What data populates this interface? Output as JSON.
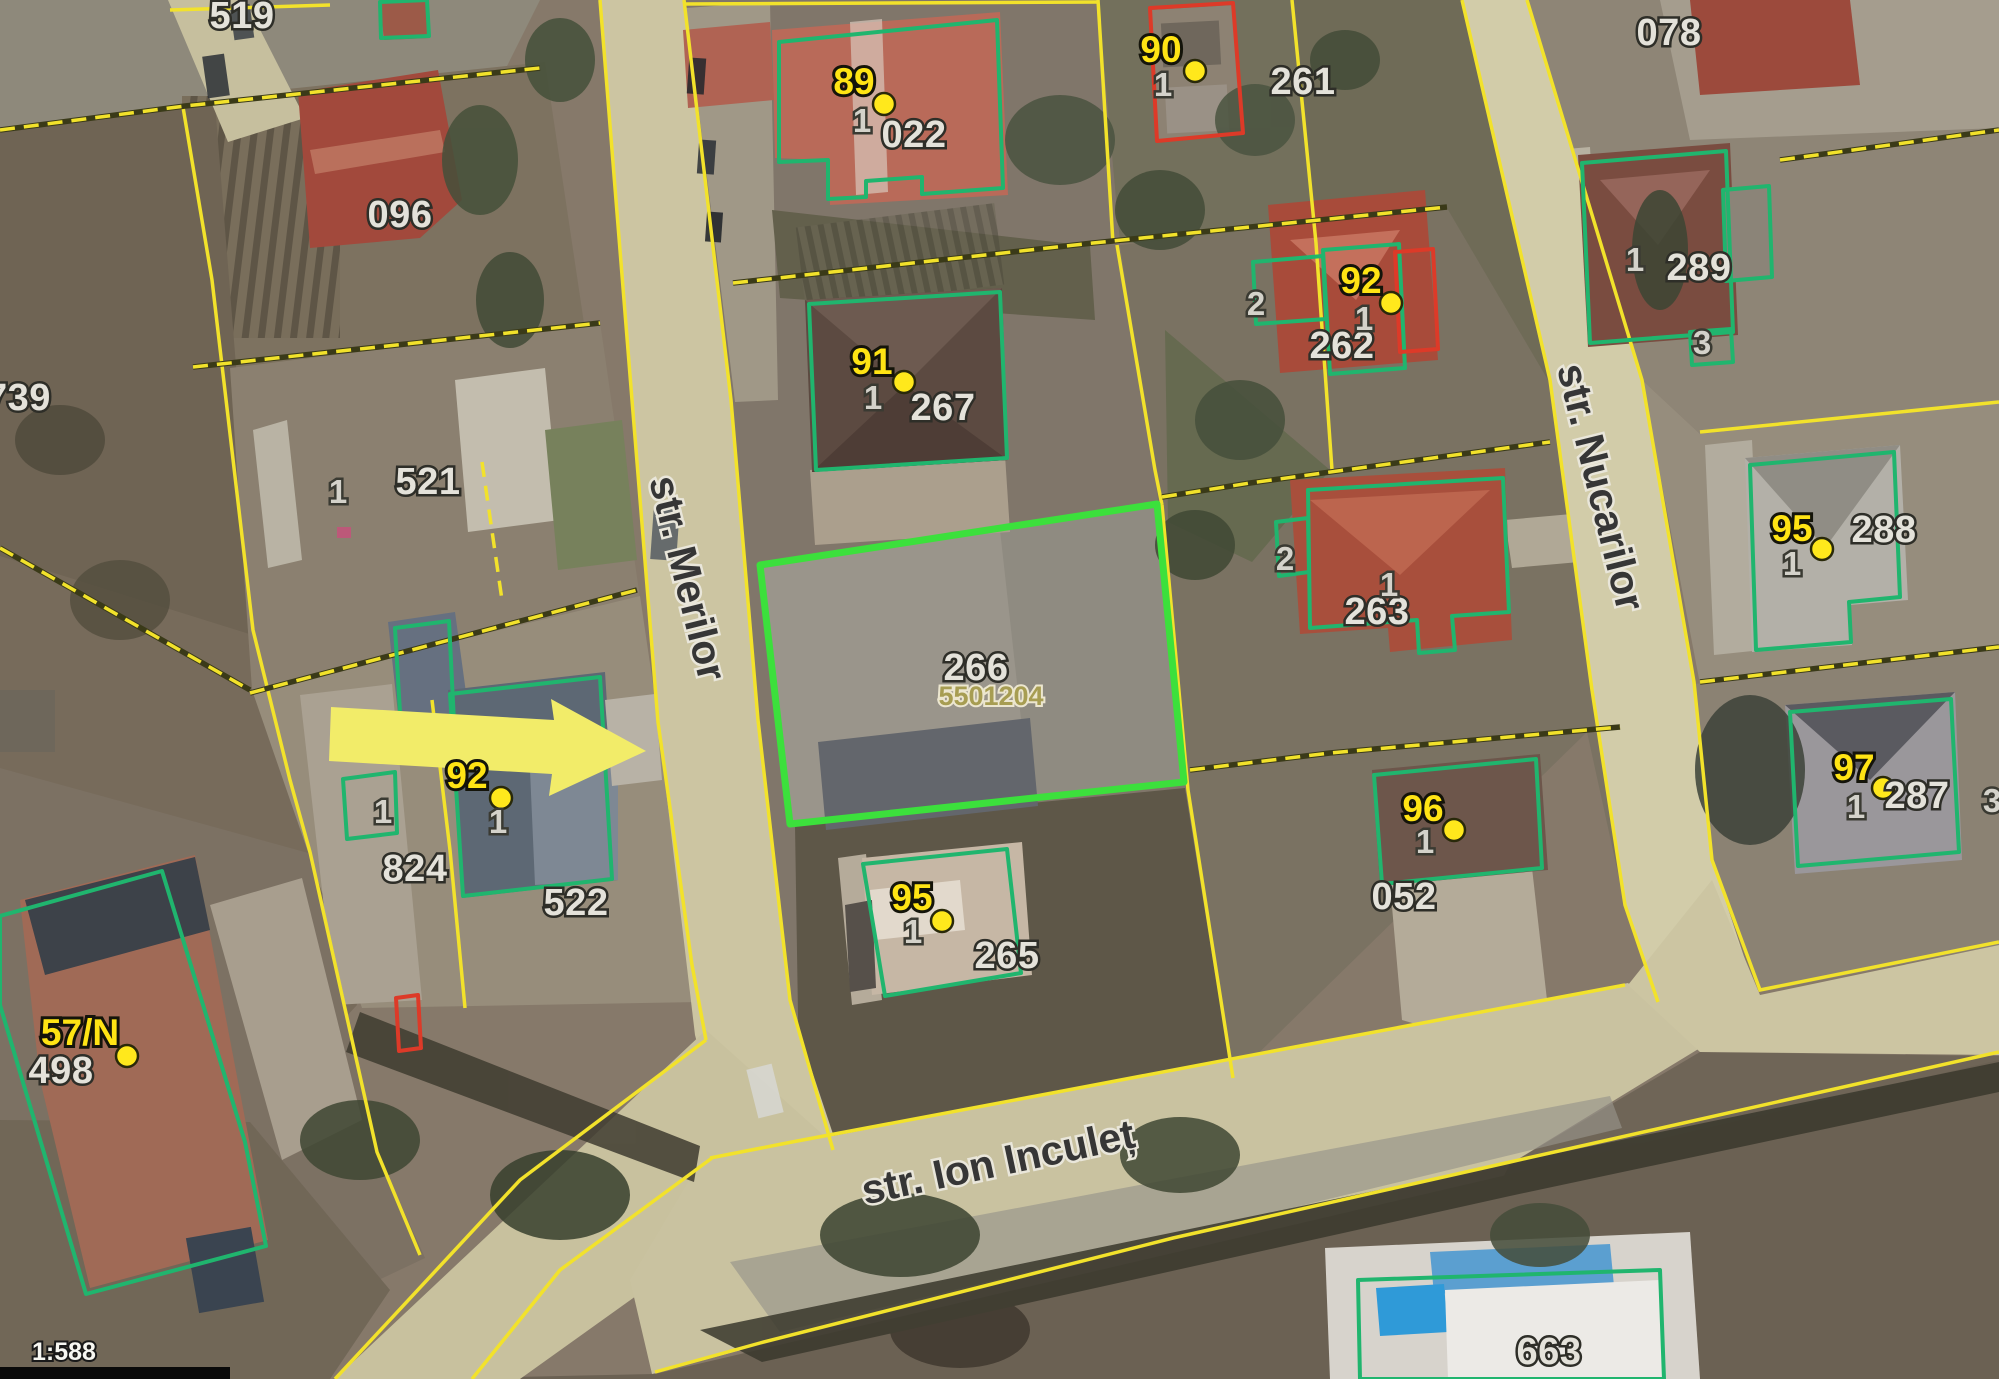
{
  "scale_label": "1:588",
  "streets": [
    "str. Merilor",
    "str. Nucarilor",
    "str. Ion Inculeț"
  ],
  "parcel_numbers": [
    "519",
    "096",
    "739",
    "521",
    "022",
    "261",
    "078",
    "289",
    "267",
    "262",
    "263",
    "266",
    "288",
    "287",
    "052",
    "265",
    "824",
    "522",
    "498",
    "663"
  ],
  "cadastral_code": "5501204",
  "address_points": [
    "89",
    "90",
    "91",
    "92",
    "92",
    "95",
    "95",
    "96",
    "97",
    "57/N"
  ],
  "unit_numbers": [
    "1",
    "1",
    "1",
    "1",
    "2",
    "1",
    "1",
    "3",
    "1",
    "2",
    "1",
    "1",
    "1",
    "1",
    "1",
    "1",
    "3"
  ],
  "colors": {
    "parcel_line": "#f2e22b",
    "building_outline": "#20b56e",
    "highlight_outline": "#3ce03c",
    "alert_outline": "#dd3a28",
    "address_point": "#ffe81c",
    "arrow": "#f2ec69"
  }
}
